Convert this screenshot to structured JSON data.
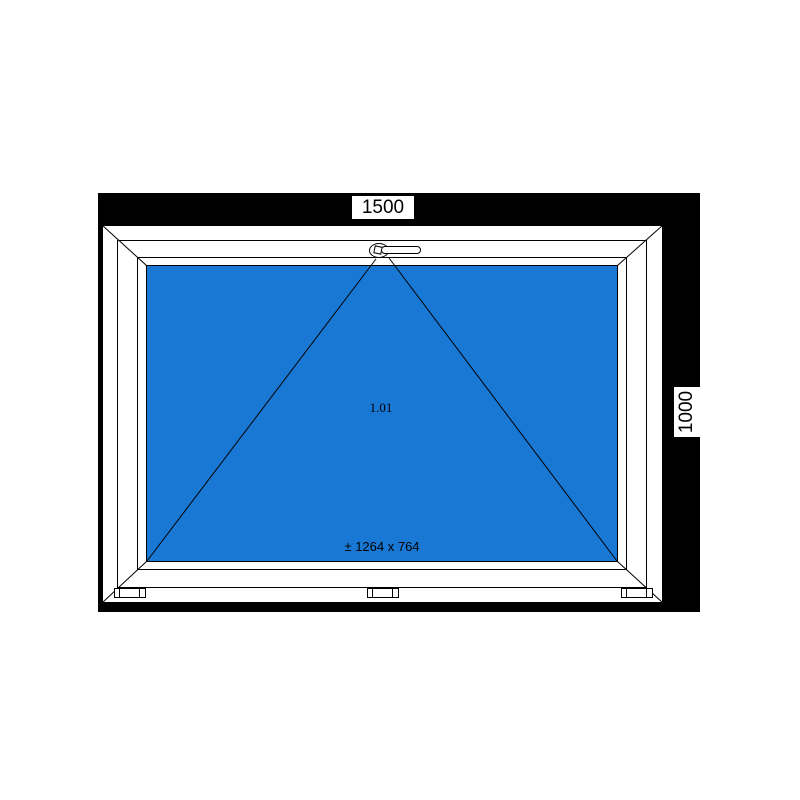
{
  "drawing": {
    "dimensions": {
      "width": "1500",
      "height": "1000"
    },
    "position_number": "1.01",
    "sash_size": "± 1264 x 764",
    "colors": {
      "glass_blue": "#1878d4",
      "dimension_band": "#000000",
      "frame_white": "#ffffff",
      "outline_black": "#000000"
    }
  }
}
